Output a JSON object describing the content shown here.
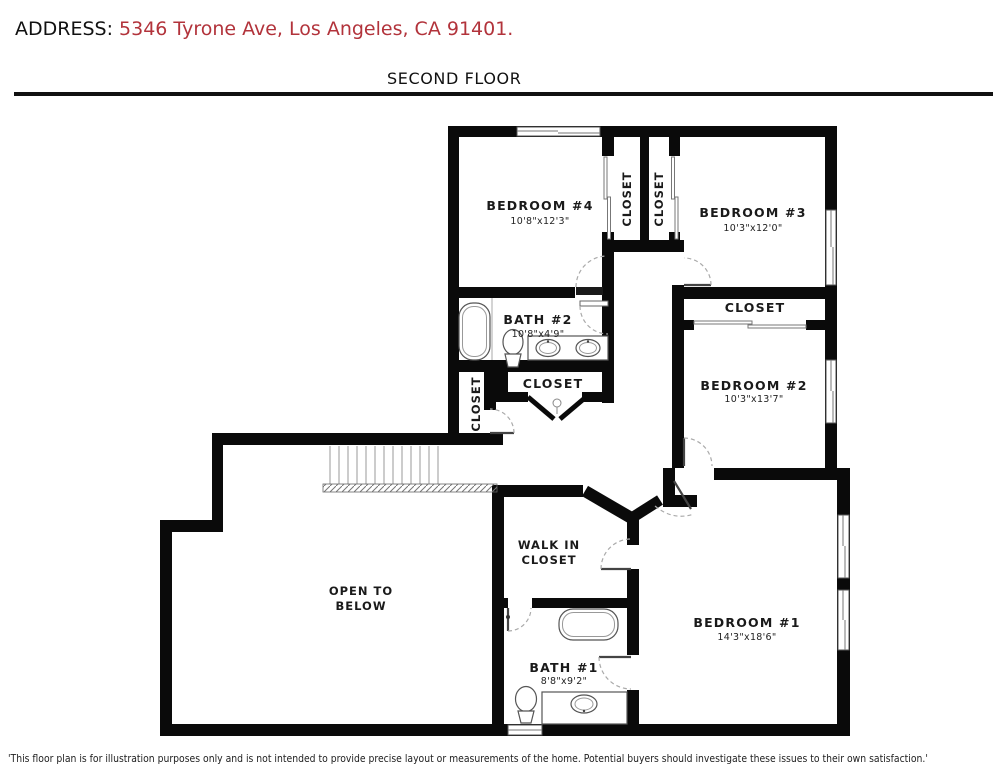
{
  "header": {
    "address_label": "ADDRESS:",
    "address_value": " 5346 Tyrone Ave, Los Angeles, CA 91401.",
    "floor_title": "SECOND FLOOR"
  },
  "colors": {
    "address_red": "#b2333b",
    "wall_black": "#0a0a0a"
  },
  "rooms": {
    "bedroom_4": {
      "label": "BEDROOM #4",
      "dims": "10'8\"x12'3\""
    },
    "bedroom_3": {
      "label": "BEDROOM #3",
      "dims": "10'3\"x12'0\""
    },
    "bedroom_2": {
      "label": "BEDROOM #2",
      "dims": "10'3\"x13'7\""
    },
    "bedroom_1": {
      "label": "BEDROOM #1",
      "dims": "14'3\"x18'6\""
    },
    "bath_2": {
      "label": "BATH #2",
      "dims": "10'8\"x4'9\""
    },
    "bath_1": {
      "label": "BATH #1",
      "dims": "8'8\"x9'2\""
    },
    "closet_bedroom4": {
      "label": "CLOSET"
    },
    "closet_bedroom3": {
      "label": "CLOSET"
    },
    "closet_hall_small": {
      "label": "CLOSET"
    },
    "closet_hall": {
      "label": "CLOSET"
    },
    "closet_bedroom2": {
      "label": "CLOSET"
    },
    "walk_in_closet": {
      "line1": "WALK IN",
      "line2": "CLOSET"
    },
    "open_to_below": {
      "line1": "OPEN TO",
      "line2": "BELOW"
    }
  },
  "footer": {
    "disclaimer": "'This floor plan is for illustration purposes only and is not intended to provide precise layout or measurements of the home. Potential buyers should investigate these issues to their own satisfaction.'"
  }
}
